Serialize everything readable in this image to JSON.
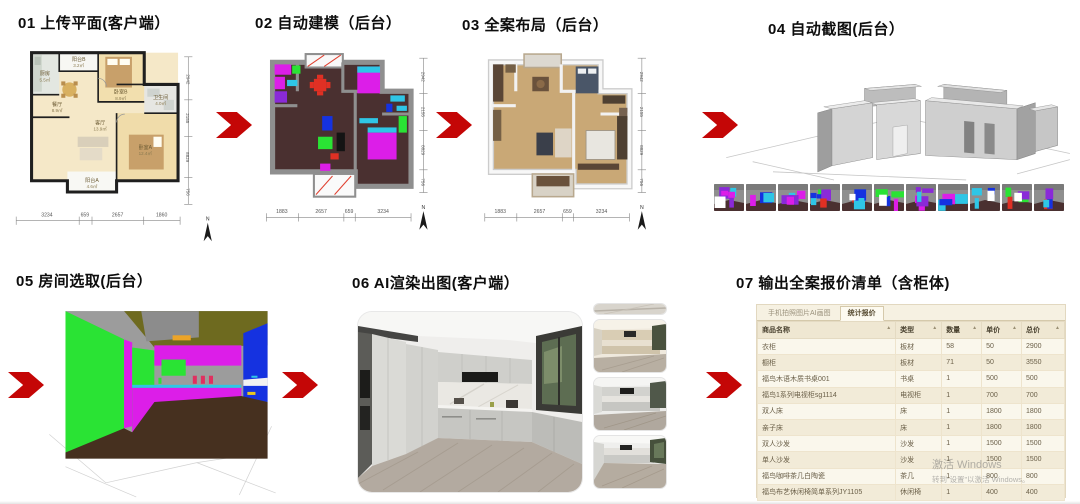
{
  "steps": [
    {
      "title": "01 上传平面(客户端）"
    },
    {
      "title": "02 自动建模（后台）"
    },
    {
      "title": "03 全案布局（后台）"
    },
    {
      "title": "04 自动截图(后台）"
    },
    {
      "title": "05 房间选取(后台）"
    },
    {
      "title": "06 AI渲染出图(客户端）"
    },
    {
      "title": "07 输出全案报价清单（含柜体)"
    }
  ],
  "colors": {
    "arrow": "#c40606",
    "seg_floor": "#4a3030",
    "seg_wall": "#909090",
    "magenta": "#dc1ee8",
    "green": "#2ae334",
    "cyan": "#2fc6e6",
    "blue": "#1532e0",
    "red": "#e03024",
    "olive": "#6e6a1f",
    "orange": "#eca428"
  },
  "panels": {
    "p1": {
      "rooms": [
        {
          "name": "厨房",
          "area": "5.5㎡"
        },
        {
          "name": "阳台B",
          "area": "3.2㎡"
        },
        {
          "name": "卧室B",
          "area": "8.9㎡"
        },
        {
          "name": "卫生间",
          "area": "4.0㎡"
        },
        {
          "name": "餐厅",
          "area": "8.9㎡"
        },
        {
          "name": "客厅",
          "area": "13.9㎡"
        },
        {
          "name": "卧室A",
          "area": "12.4㎡"
        },
        {
          "name": "阳台A",
          "area": "4.6㎡"
        }
      ],
      "dims_bottom": [
        "3234",
        "659",
        "2657",
        "1860"
      ],
      "dims_right": [
        "2942",
        "2155",
        "8829",
        "756"
      ],
      "compass": "N"
    },
    "p2": {
      "dims_bottom": [
        "1883",
        "2657",
        "659",
        "3234"
      ],
      "dims_right": [
        "2942",
        "2155",
        "8829",
        "756"
      ],
      "compass": "N"
    },
    "p3": {
      "dims_bottom": [
        "1883",
        "2657",
        "659",
        "3234"
      ],
      "dims_right": [
        "2942",
        "2155",
        "8829",
        "756"
      ],
      "compass": "N"
    },
    "p4": {
      "strip_count": 11
    }
  },
  "quote": {
    "tabs": [
      {
        "label": "手机拍照图片AI画图",
        "active": false
      },
      {
        "label": "统计报价",
        "active": true
      }
    ],
    "sort_icon": "▲",
    "headers": [
      "商品名称",
      "类型",
      "数量",
      "单价",
      "总价"
    ],
    "rows": [
      [
        "衣柜",
        "板材",
        "58",
        "50",
        "2900"
      ],
      [
        "橱柜",
        "板材",
        "71",
        "50",
        "3550"
      ],
      [
        "福鸟木语木质书桌001",
        "书桌",
        "1",
        "500",
        "500"
      ],
      [
        "福鸟1系列电视柜sg1114",
        "电视柜",
        "1",
        "700",
        "700"
      ],
      [
        "双人床",
        "床",
        "1",
        "1800",
        "1800"
      ],
      [
        "亲子床",
        "床",
        "1",
        "1800",
        "1800"
      ],
      [
        "双人沙发",
        "沙发",
        "1",
        "1500",
        "1500"
      ],
      [
        "单人沙发",
        "沙发",
        "1",
        "1500",
        "1500"
      ],
      [
        "福鸟咖啡茶几白陶瓷",
        "茶几",
        "1",
        "800",
        "800"
      ],
      [
        "福鸟布艺休闲椅简单系列JY1105",
        "休闲椅",
        "1",
        "400",
        "400"
      ],
      [
        "福鸟咖啡休闲椅布艺",
        "休闲椅",
        "1",
        "400",
        "400"
      ]
    ]
  },
  "watermark": {
    "line1": "激活 Windows",
    "line2": "转到“设置”以激活 Windows。"
  }
}
